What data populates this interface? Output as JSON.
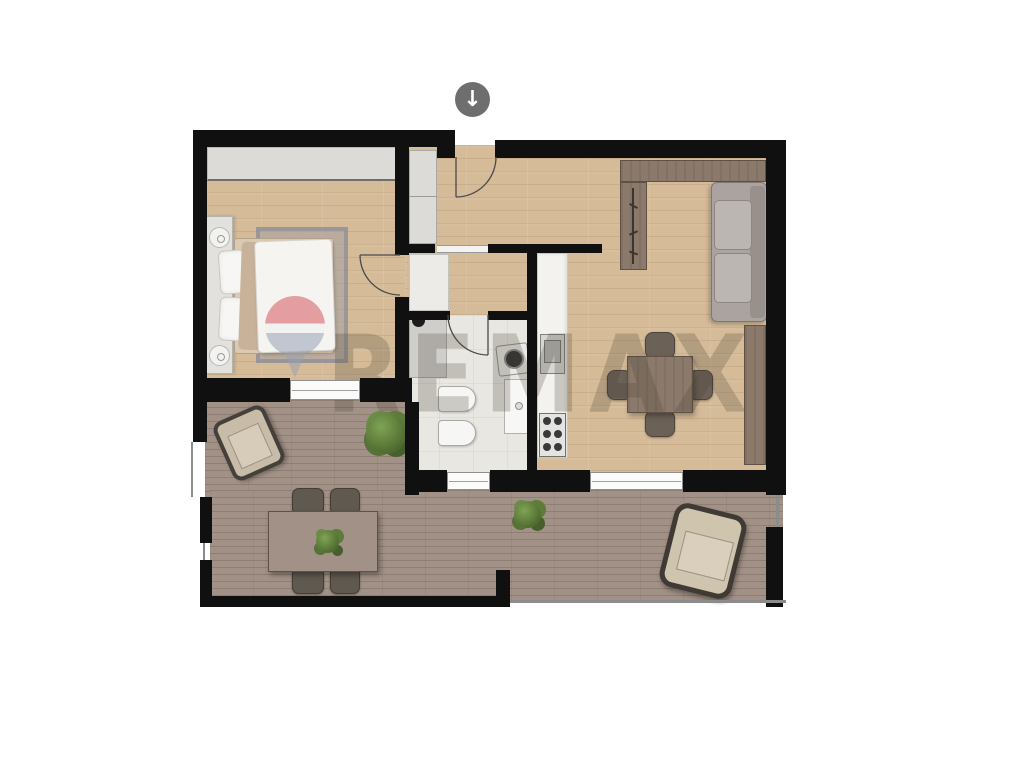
{
  "watermark": {
    "text": "REMAX",
    "logo": "remax-balloon-pin-icon"
  },
  "entrance_marker": {
    "glyph": "↓",
    "icon": "down-arrow-icon"
  },
  "icons": {
    "entrance": "down-arrow-icon",
    "shower": "shower-head-icon",
    "coat_rack": "coat-rack-icon"
  },
  "colors": {
    "wall": "#101010",
    "wood_floor": "#d5bb98",
    "terrace_deck": "#a29186",
    "bathroom_floor": "#e9e7e2",
    "counter_marble": "#f3f2ef",
    "dark_wood_furniture": "#8b7a6b",
    "sofa_gray": "#aaa3a0",
    "wardrobe_gray": "#dcdbd7",
    "rug_gray_blue": "#9aa0b2",
    "plant_green": "#5d7c39",
    "badge_gray": "#6e6e6e",
    "balloon_red": "#d44a55",
    "balloon_blue": "#8e9ab0",
    "watermark_gray": "rgba(72,62,52,0.24)"
  }
}
